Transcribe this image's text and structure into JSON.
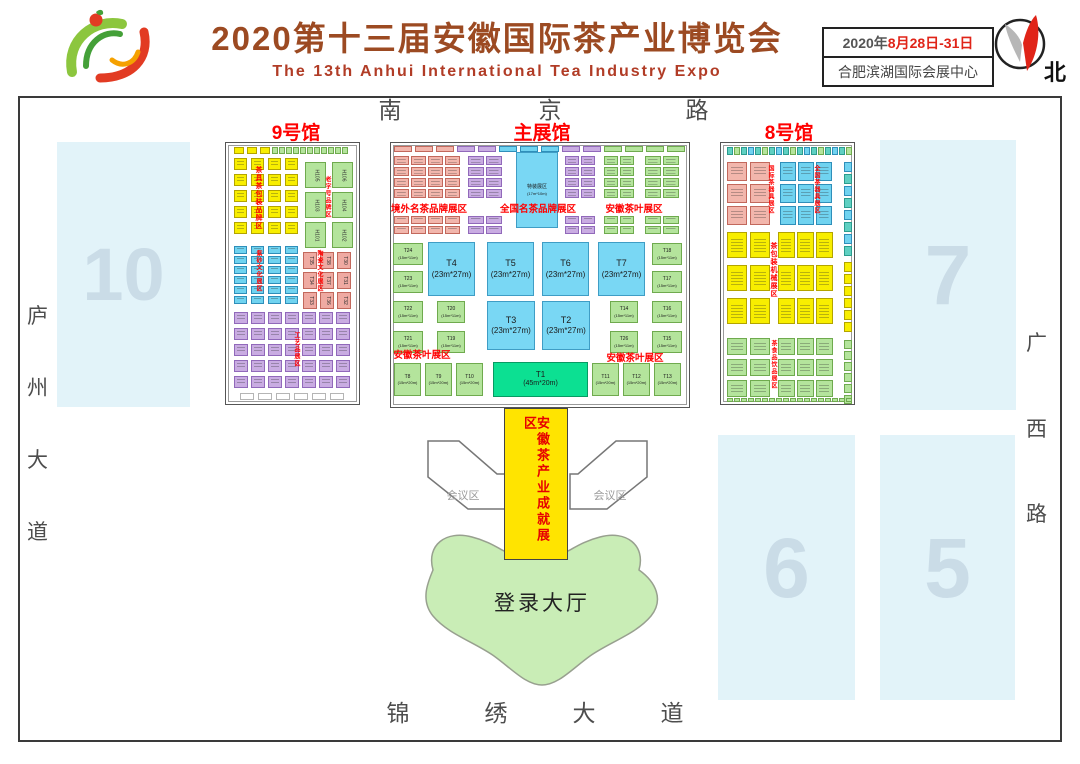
{
  "header": {
    "title_cn": "2020第十三届安徽国际茶产业博览会",
    "title_en": "The 13th  Anhui International Tea Industry Expo",
    "date_prefix": "2020年",
    "date_range": "8月28日-31日",
    "venue": "合肥滨湖国际会展中心",
    "compass": "北",
    "title_color": "#9c4a22",
    "accent_red": "#e02418"
  },
  "roads": {
    "top": {
      "chars": [
        "南",
        "京",
        "路"
      ],
      "xs": [
        390,
        550,
        697
      ],
      "y": 99
    },
    "bottom": {
      "chars": [
        "锦",
        "绣",
        "大",
        "道"
      ],
      "xs": [
        398,
        496,
        584,
        672
      ],
      "y": 702
    },
    "left": {
      "chars": [
        "庐",
        "州",
        "大",
        "道"
      ],
      "x": 27,
      "ys": [
        306,
        378,
        450,
        522
      ]
    },
    "right": {
      "chars": [
        "广",
        "西",
        "路"
      ],
      "x": 1026,
      "ys": [
        333,
        419,
        504
      ]
    }
  },
  "map": {
    "hall9": {
      "label": "9号馆"
    },
    "main_hall": {
      "label": "主展馆"
    },
    "hall8": {
      "label": "8号馆"
    },
    "blocks": [
      {
        "num": "10",
        "x": 57,
        "y": 142,
        "w": 133,
        "h": 265,
        "fs": 74
      },
      {
        "num": "7",
        "x": 880,
        "y": 140,
        "w": 136,
        "h": 270,
        "fs": 84
      },
      {
        "num": "6",
        "x": 718,
        "y": 435,
        "w": 137,
        "h": 265,
        "fs": 84
      },
      {
        "num": "5",
        "x": 880,
        "y": 435,
        "w": 135,
        "h": 265,
        "fs": 84
      }
    ],
    "corridor": {
      "label": "安徽茶产业成就展区"
    },
    "conference": {
      "label": "会议区",
      "left_pts": "428,441 459,441 497,474 505,474 505,509 468,509 428,477",
      "right_pts": "647,441 616,441 578,474 570,474 570,509 607,509 647,477"
    },
    "lobby": {
      "label": "登录大厅",
      "path": "M433,570 C426,545 446,530 472,537 C488,541 498,548 504,551 L568,551 C574,548 584,541 600,537 C626,530 646,545 639,570 C656,582 664,600 651,616 C636,634 610,642 590,656 C572,669 558,685 542,685 C526,685 512,669 494,656 C474,642 448,634 433,616 C420,600 428,582 433,570 Z"
    },
    "palette": {
      "yellow": {
        "bg": "#f8ee00",
        "bd": "#b3a400"
      },
      "green": {
        "bg": "#b4e49c",
        "bd": "#6faa4e"
      },
      "cyan": {
        "bg": "#70d3f0",
        "bd": "#2f8fba"
      },
      "teal": {
        "bg": "#5fd0c2",
        "bd": "#2b9c8e"
      },
      "pink": {
        "bg": "#f2b6ac",
        "bd": "#c2685c"
      },
      "pinkD": {
        "bg": "#efaaa2",
        "bd": "#c2685c"
      },
      "purple": {
        "bg": "#c9ace2",
        "bd": "#9169ba"
      },
      "bigblue": {
        "bg": "#79d7f4",
        "bd": "#3f9dc5"
      },
      "bright": {
        "bg": "#0ce092",
        "bd": "#089a63"
      },
      "plain": {
        "bg": "#ffffff",
        "bd": "#b5b5b5"
      }
    },
    "grids": [
      {
        "x": 234,
        "y": 147,
        "cols": 3,
        "rows": 1,
        "cw": 10,
        "ch": 7,
        "gx": 3,
        "gy": 0,
        "c": "yellow"
      },
      {
        "x": 272,
        "y": 147,
        "cols": 11,
        "rows": 1,
        "cw": 6,
        "ch": 7,
        "gx": 1,
        "gy": 0,
        "c": "green"
      },
      {
        "x": 234,
        "y": 158,
        "cols": 4,
        "rows": 5,
        "cw": 13,
        "ch": 12,
        "gx": 4,
        "gy": 4,
        "c": "yellow",
        "tex": 1
      },
      {
        "x": 234,
        "y": 246,
        "cols": 4,
        "rows": 6,
        "cw": 13,
        "ch": 8,
        "gx": 4,
        "gy": 2,
        "c": "cyan",
        "tex": 1
      },
      {
        "x": 234,
        "y": 312,
        "cols": 7,
        "rows": 5,
        "cw": 14,
        "ch": 12,
        "gx": 3,
        "gy": 4,
        "c": "purple",
        "tex": 1
      },
      {
        "x": 240,
        "y": 393,
        "cols": 6,
        "rows": 1,
        "cw": 14,
        "ch": 7,
        "gx": 4,
        "gy": 0,
        "c": "plain"
      },
      {
        "x": 394,
        "y": 146,
        "cols": 14,
        "rows": 1,
        "cw": 18,
        "ch": 6,
        "gx": 3,
        "gy": 0,
        "cycle": [
          "pink",
          "pink",
          "pink",
          "purple",
          "purple",
          "cyan",
          "cyan",
          "cyan",
          "purple",
          "purple",
          "green",
          "green",
          "green",
          "green"
        ]
      },
      {
        "x": 394,
        "y": 156,
        "cols": 4,
        "rows": 4,
        "cw": 15,
        "ch": 9,
        "gx": 2,
        "gy": 2,
        "c": "pink",
        "tex": 1
      },
      {
        "x": 394,
        "y": 216,
        "cols": 4,
        "rows": 2,
        "cw": 15,
        "ch": 8,
        "gx": 2,
        "gy": 2,
        "c": "pink",
        "tex": 1
      },
      {
        "x": 468,
        "y": 156,
        "cols": 2,
        "rows": 4,
        "cw": 16,
        "ch": 9,
        "gx": 2,
        "gy": 2,
        "c": "purple",
        "tex": 1
      },
      {
        "x": 468,
        "y": 216,
        "cols": 2,
        "rows": 2,
        "cw": 16,
        "ch": 8,
        "gx": 2,
        "gy": 2,
        "c": "purple",
        "tex": 1
      },
      {
        "x": 565,
        "y": 156,
        "cols": 2,
        "rows": 4,
        "cw": 14,
        "ch": 9,
        "gx": 2,
        "gy": 2,
        "c": "purple",
        "tex": 1
      },
      {
        "x": 565,
        "y": 216,
        "cols": 2,
        "rows": 2,
        "cw": 14,
        "ch": 8,
        "gx": 2,
        "gy": 2,
        "c": "purple",
        "tex": 1
      },
      {
        "x": 604,
        "y": 156,
        "cols": 2,
        "rows": 4,
        "cw": 14,
        "ch": 9,
        "gx": 2,
        "gy": 2,
        "c": "green",
        "tex": 1
      },
      {
        "x": 604,
        "y": 216,
        "cols": 2,
        "rows": 2,
        "cw": 14,
        "ch": 8,
        "gx": 2,
        "gy": 2,
        "c": "green",
        "tex": 1
      },
      {
        "x": 645,
        "y": 156,
        "cols": 2,
        "rows": 4,
        "cw": 16,
        "ch": 9,
        "gx": 2,
        "gy": 2,
        "c": "green",
        "tex": 1
      },
      {
        "x": 645,
        "y": 216,
        "cols": 2,
        "rows": 2,
        "cw": 16,
        "ch": 8,
        "gx": 2,
        "gy": 2,
        "c": "green",
        "tex": 1
      },
      {
        "x": 727,
        "y": 147,
        "cols": 18,
        "rows": 1,
        "cw": 6,
        "ch": 8,
        "gx": 1,
        "gy": 0,
        "cycle": [
          "teal",
          "green",
          "teal",
          "cyan"
        ]
      },
      {
        "x": 727,
        "y": 162,
        "cols": 2,
        "rows": 3,
        "cw": 20,
        "ch": 19,
        "gx": 3,
        "gy": 3,
        "c": "pink",
        "tex": 1
      },
      {
        "x": 780,
        "y": 162,
        "cols": 3,
        "rows": 3,
        "cw": 16,
        "ch": 19,
        "gx": 2,
        "gy": 3,
        "c": "cyan",
        "tex": 1
      },
      {
        "x": 844,
        "y": 162,
        "cols": 1,
        "rows": 8,
        "cw": 8,
        "ch": 10,
        "gx": 0,
        "gy": 2,
        "cycle": [
          "cyan",
          "teal"
        ]
      },
      {
        "x": 727,
        "y": 232,
        "cols": 2,
        "rows": 3,
        "cw": 20,
        "ch": 26,
        "gx": 3,
        "gy": 7,
        "c": "yellow",
        "tex": 1
      },
      {
        "x": 778,
        "y": 232,
        "cols": 3,
        "rows": 3,
        "cw": 17,
        "ch": 26,
        "gx": 2,
        "gy": 7,
        "c": "yellow",
        "tex": 1
      },
      {
        "x": 844,
        "y": 262,
        "cols": 1,
        "rows": 6,
        "cw": 8,
        "ch": 10,
        "gx": 0,
        "gy": 2,
        "c": "yellow"
      },
      {
        "x": 727,
        "y": 338,
        "cols": 2,
        "rows": 3,
        "cw": 20,
        "ch": 17,
        "gx": 3,
        "gy": 4,
        "c": "green",
        "tex": 1
      },
      {
        "x": 778,
        "y": 338,
        "cols": 3,
        "rows": 3,
        "cw": 17,
        "ch": 17,
        "gx": 2,
        "gy": 4,
        "c": "green",
        "tex": 1
      },
      {
        "x": 844,
        "y": 340,
        "cols": 1,
        "rows": 6,
        "cw": 8,
        "ch": 9,
        "gx": 0,
        "gy": 2,
        "c": "green"
      },
      {
        "x": 727,
        "y": 398,
        "cols": 18,
        "rows": 1,
        "cw": 6,
        "ch": 4,
        "gx": 1,
        "gy": 0,
        "c": "green"
      }
    ],
    "booths_rot": [
      {
        "id": "H105",
        "x": 305,
        "y": 162,
        "w": 21,
        "h": 26,
        "c": "green"
      },
      {
        "id": "H106",
        "x": 332,
        "y": 162,
        "w": 21,
        "h": 26,
        "c": "green"
      },
      {
        "id": "H103",
        "x": 305,
        "y": 192,
        "w": 21,
        "h": 26,
        "c": "green"
      },
      {
        "id": "H104",
        "x": 332,
        "y": 192,
        "w": 21,
        "h": 26,
        "c": "green"
      },
      {
        "id": "H101",
        "x": 305,
        "y": 222,
        "w": 21,
        "h": 26,
        "c": "green"
      },
      {
        "id": "H102",
        "x": 332,
        "y": 222,
        "w": 21,
        "h": 26,
        "c": "green"
      },
      {
        "id": "T35",
        "x": 303,
        "y": 252,
        "w": 14,
        "h": 17,
        "c": "pinkD"
      },
      {
        "id": "T38",
        "x": 320,
        "y": 252,
        "w": 14,
        "h": 17,
        "c": "pinkD"
      },
      {
        "id": "T30",
        "x": 337,
        "y": 252,
        "w": 14,
        "h": 17,
        "c": "pinkD"
      },
      {
        "id": "T34",
        "x": 303,
        "y": 272,
        "w": 14,
        "h": 17,
        "c": "pinkD"
      },
      {
        "id": "T37",
        "x": 320,
        "y": 272,
        "w": 14,
        "h": 17,
        "c": "pinkD"
      },
      {
        "id": "T31",
        "x": 337,
        "y": 272,
        "w": 14,
        "h": 17,
        "c": "pinkD"
      },
      {
        "id": "T33",
        "x": 303,
        "y": 292,
        "w": 14,
        "h": 17,
        "c": "pinkD"
      },
      {
        "id": "T36",
        "x": 320,
        "y": 292,
        "w": 14,
        "h": 17,
        "c": "pinkD"
      },
      {
        "id": "T32",
        "x": 337,
        "y": 292,
        "w": 14,
        "h": 17,
        "c": "pinkD"
      }
    ],
    "booths": [
      {
        "id": "特装展区",
        "size": "(17m*10m)",
        "x": 516,
        "y": 152,
        "w": 42,
        "h": 76,
        "c": "bigblue",
        "fs": 5
      },
      {
        "id": "T4",
        "size": "(23m*27m)",
        "x": 428,
        "y": 242,
        "w": 47,
        "h": 54,
        "c": "bigblue",
        "fs": 9
      },
      {
        "id": "T5",
        "size": "(23m*27m)",
        "x": 487,
        "y": 242,
        "w": 47,
        "h": 54,
        "c": "bigblue",
        "fs": 9
      },
      {
        "id": "T6",
        "size": "(23m*27m)",
        "x": 542,
        "y": 242,
        "w": 47,
        "h": 54,
        "c": "bigblue",
        "fs": 9
      },
      {
        "id": "T7",
        "size": "(23m*27m)",
        "x": 598,
        "y": 242,
        "w": 47,
        "h": 54,
        "c": "bigblue",
        "fs": 9
      },
      {
        "id": "T3",
        "size": "(23m*27m)",
        "x": 487,
        "y": 301,
        "w": 48,
        "h": 49,
        "c": "bigblue",
        "fs": 9
      },
      {
        "id": "T2",
        "size": "(23m*27m)",
        "x": 542,
        "y": 301,
        "w": 48,
        "h": 49,
        "c": "bigblue",
        "fs": 9
      },
      {
        "id": "T1",
        "size": "(45m*20m)",
        "x": 493,
        "y": 362,
        "w": 95,
        "h": 35,
        "c": "bright",
        "fs": 8
      },
      {
        "id": "T24",
        "size": "(15m*11m)",
        "x": 393,
        "y": 243,
        "w": 30,
        "h": 22,
        "c": "green",
        "fs": 5
      },
      {
        "id": "T23",
        "size": "(15m*11m)",
        "x": 393,
        "y": 271,
        "w": 30,
        "h": 22,
        "c": "green",
        "fs": 5
      },
      {
        "id": "T22",
        "size": "(15m*11m)",
        "x": 393,
        "y": 301,
        "w": 30,
        "h": 22,
        "c": "green",
        "fs": 5
      },
      {
        "id": "T21",
        "size": "(15m*11m)",
        "x": 393,
        "y": 331,
        "w": 30,
        "h": 22,
        "c": "green",
        "fs": 5
      },
      {
        "id": "T20",
        "size": "(15m*11m)",
        "x": 437,
        "y": 301,
        "w": 28,
        "h": 22,
        "c": "green",
        "fs": 5
      },
      {
        "id": "T19",
        "size": "(15m*11m)",
        "x": 437,
        "y": 331,
        "w": 28,
        "h": 22,
        "c": "green",
        "fs": 5
      },
      {
        "id": "T14",
        "size": "(15m*11m)",
        "x": 610,
        "y": 301,
        "w": 28,
        "h": 22,
        "c": "green",
        "fs": 5
      },
      {
        "id": "T26",
        "size": "(15m*11m)",
        "x": 610,
        "y": 331,
        "w": 28,
        "h": 22,
        "c": "green",
        "fs": 5
      },
      {
        "id": "T18",
        "size": "(15m*11m)",
        "x": 652,
        "y": 243,
        "w": 30,
        "h": 22,
        "c": "green",
        "fs": 5
      },
      {
        "id": "T17",
        "size": "(15m*11m)",
        "x": 652,
        "y": 271,
        "w": 30,
        "h": 22,
        "c": "green",
        "fs": 5
      },
      {
        "id": "T16",
        "size": "(15m*11m)",
        "x": 652,
        "y": 301,
        "w": 30,
        "h": 22,
        "c": "green",
        "fs": 5
      },
      {
        "id": "T15",
        "size": "(15m*11m)",
        "x": 652,
        "y": 331,
        "w": 30,
        "h": 22,
        "c": "green",
        "fs": 5
      },
      {
        "id": "T8",
        "size": "(15m*20m)",
        "x": 394,
        "y": 363,
        "w": 27,
        "h": 33,
        "c": "green",
        "fs": 5
      },
      {
        "id": "T9",
        "size": "(15m*20m)",
        "x": 425,
        "y": 363,
        "w": 27,
        "h": 33,
        "c": "green",
        "fs": 5
      },
      {
        "id": "T10",
        "size": "(15m*20m)",
        "x": 456,
        "y": 363,
        "w": 27,
        "h": 33,
        "c": "green",
        "fs": 5
      },
      {
        "id": "T11",
        "size": "(15m*20m)",
        "x": 592,
        "y": 363,
        "w": 27,
        "h": 33,
        "c": "green",
        "fs": 5
      },
      {
        "id": "T12",
        "size": "(15m*20m)",
        "x": 623,
        "y": 363,
        "w": 27,
        "h": 33,
        "c": "green",
        "fs": 5
      },
      {
        "id": "T13",
        "size": "(15m*20m)",
        "x": 654,
        "y": 363,
        "w": 27,
        "h": 33,
        "c": "green",
        "fs": 5
      }
    ],
    "hlabels": [
      {
        "text": "境外名茶品牌展区",
        "x": 429,
        "y": 201
      },
      {
        "text": "全国名茶品牌展区",
        "x": 538,
        "y": 201
      },
      {
        "text": "安徽茶叶展区",
        "x": 634,
        "y": 201
      },
      {
        "text": "安徽茶叶展区",
        "x": 422,
        "y": 347
      },
      {
        "text": "安徽茶叶展区",
        "x": 635,
        "y": 350
      }
    ],
    "vlabels": [
      {
        "text": "茶具茶包装品牌区",
        "x": 255,
        "y": 166,
        "fs": 7
      },
      {
        "text": "老字号品牌区",
        "x": 324,
        "y": 176,
        "fs": 6
      },
      {
        "text": "紫砂文化展区",
        "x": 255,
        "y": 250,
        "fs": 6
      },
      {
        "text": "陶瓷文化展区",
        "x": 316,
        "y": 250,
        "fs": 6
      },
      {
        "text": "工艺品展区",
        "x": 293,
        "y": 332,
        "fs": 6
      },
      {
        "text": "国际茶器具展区",
        "x": 767,
        "y": 165,
        "fs": 6
      },
      {
        "text": "全国茶器具展区",
        "x": 813,
        "y": 165,
        "fs": 6
      },
      {
        "text": "茶包装机械展区",
        "x": 770,
        "y": 242,
        "fs": 7
      },
      {
        "text": "茶食品饮品展区",
        "x": 770,
        "y": 340,
        "fs": 6
      }
    ]
  }
}
